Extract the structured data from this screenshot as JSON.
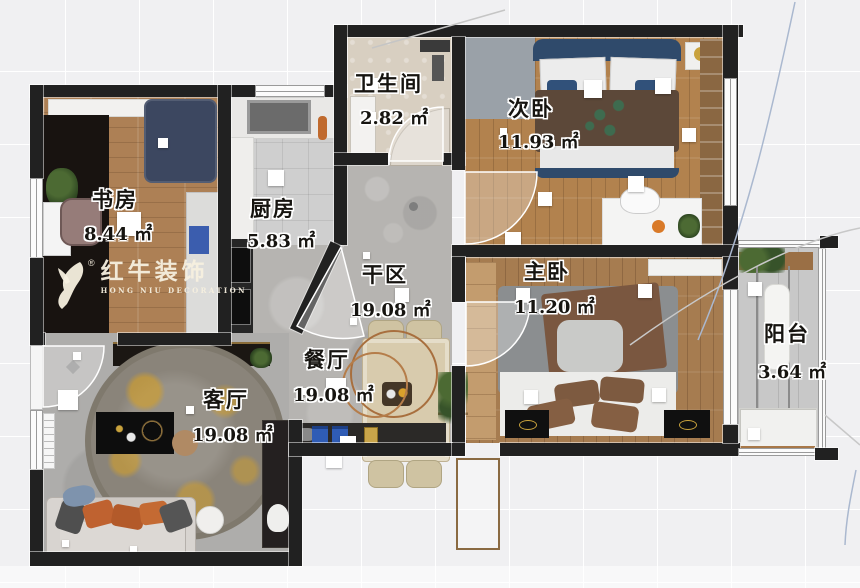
{
  "plan": {
    "title_hint": "apartment floor plan rendering",
    "rooms": [
      {
        "id": "study",
        "name": "书房",
        "area": "8.44 ㎡"
      },
      {
        "id": "kitchen",
        "name": "厨房",
        "area": "5.83 ㎡"
      },
      {
        "id": "bathroom",
        "name": "卫生间",
        "area": "2.82 ㎡"
      },
      {
        "id": "second-bedroom",
        "name": "次卧",
        "area": "11.93 ㎡"
      },
      {
        "id": "master-bedroom",
        "name": "主卧",
        "area": "11.20 ㎡"
      },
      {
        "id": "dry-area",
        "name": "干区",
        "area": "19.08 ㎡"
      },
      {
        "id": "dining-room",
        "name": "餐厅",
        "area": "19.08 ㎡"
      },
      {
        "id": "living-room",
        "name": "客厅",
        "area": "19.08 ㎡"
      },
      {
        "id": "balcony",
        "name": "阳台",
        "area": "3.64 ㎡"
      }
    ],
    "watermark": {
      "brand": "红牛装饰",
      "brand_en": "HONG NIU DECORATION",
      "registered_mark": "®"
    },
    "colors": {
      "wall": "#212121",
      "wood_floor": "#b2824e",
      "concrete_floor": "#b6b4b1",
      "accent_gold": "#d29f2b",
      "accent_orange": "#c2622f",
      "navy_bed": "#2f4a6b"
    }
  }
}
